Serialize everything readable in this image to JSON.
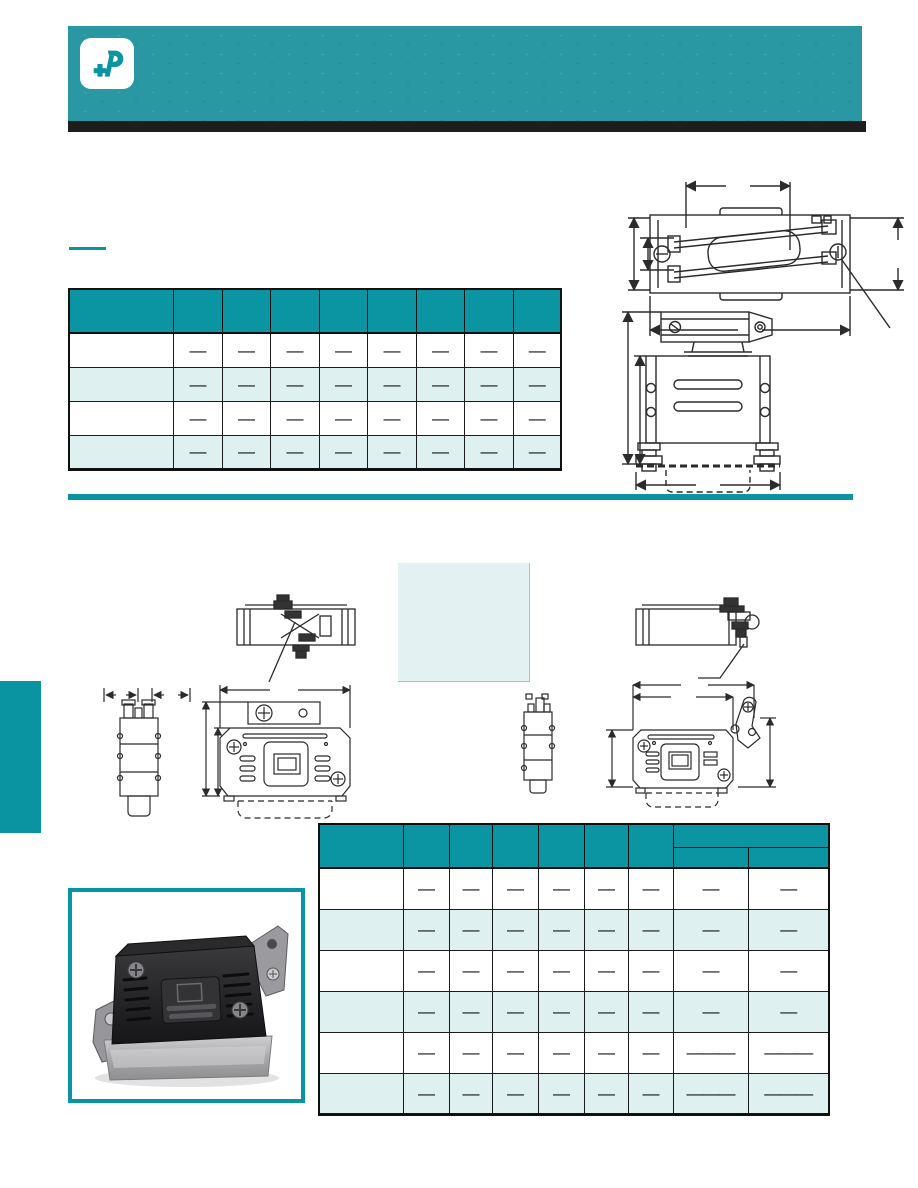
{
  "page": {
    "width_px": 918,
    "height_px": 1188,
    "background": "#ffffff"
  },
  "colors": {
    "banner_teal": "#2a98a2",
    "accent_teal": "#0a94a2",
    "table_header_teal": "#0b94a1",
    "row_alt_teal": "#dff0f0",
    "spec_box_teal": "#e3f1f2",
    "black_bar": "#1d1d1b",
    "photo_frame_teal": "#0795a5",
    "drawing_line": "#2b2b2b"
  },
  "header": {
    "logo_icon": "positronic-logo",
    "banner_text": ""
  },
  "section1": {
    "heading_text": "",
    "table1": {
      "col_headers": [
        "",
        "",
        "",
        "",
        "",
        "",
        "",
        "",
        ""
      ],
      "rows": [
        {
          "cells": [
            "",
            "—",
            "—",
            "—",
            "—",
            "—",
            "—",
            "—",
            "—"
          ]
        },
        {
          "cells": [
            "",
            "—",
            "—",
            "—",
            "—",
            "—",
            "—",
            "—",
            "—"
          ]
        },
        {
          "cells": [
            "",
            "—",
            "—",
            "—",
            "—",
            "—",
            "—",
            "—",
            "—"
          ]
        },
        {
          "cells": [
            "",
            "—",
            "—",
            "—",
            "—",
            "—",
            "—",
            "—",
            "—"
          ]
        }
      ]
    }
  },
  "section2": {
    "table2": {
      "col_headers": [
        "",
        "",
        "",
        "",
        "",
        "",
        ""
      ],
      "group_header": "",
      "sub_headers": [
        "",
        ""
      ],
      "rows": [
        {
          "cells": [
            "",
            "—",
            "—",
            "—",
            "—",
            "—",
            "—",
            "—",
            "—"
          ]
        },
        {
          "cells": [
            "",
            "—",
            "—",
            "—",
            "—",
            "—",
            "—",
            "—",
            "—"
          ]
        },
        {
          "cells": [
            "",
            "—",
            "—",
            "—",
            "—",
            "—",
            "—",
            "—",
            "—"
          ]
        },
        {
          "cells": [
            "",
            "—",
            "—",
            "—",
            "—",
            "—",
            "—",
            "—",
            "—"
          ]
        },
        {
          "cells": [
            "",
            "—",
            "—",
            "—",
            "—",
            "—",
            "—",
            "———",
            "———"
          ]
        },
        {
          "cells": [
            "",
            "—",
            "—",
            "—",
            "—",
            "—",
            "—",
            "———",
            "———"
          ]
        }
      ]
    }
  },
  "drawings": {
    "top_view_clamp": "top view with cable clamp and dimensions",
    "front_view_hood": "front view of hood with jackscrews",
    "mid_top_view_left": "top view low-profile hood",
    "mid_top_view_right": "top view hood with slide latch",
    "pair_left": "side and front view with mounting bracket",
    "pair_right": "side and front view with latch lever"
  },
  "photo": {
    "subject": "connector hood product photo"
  }
}
